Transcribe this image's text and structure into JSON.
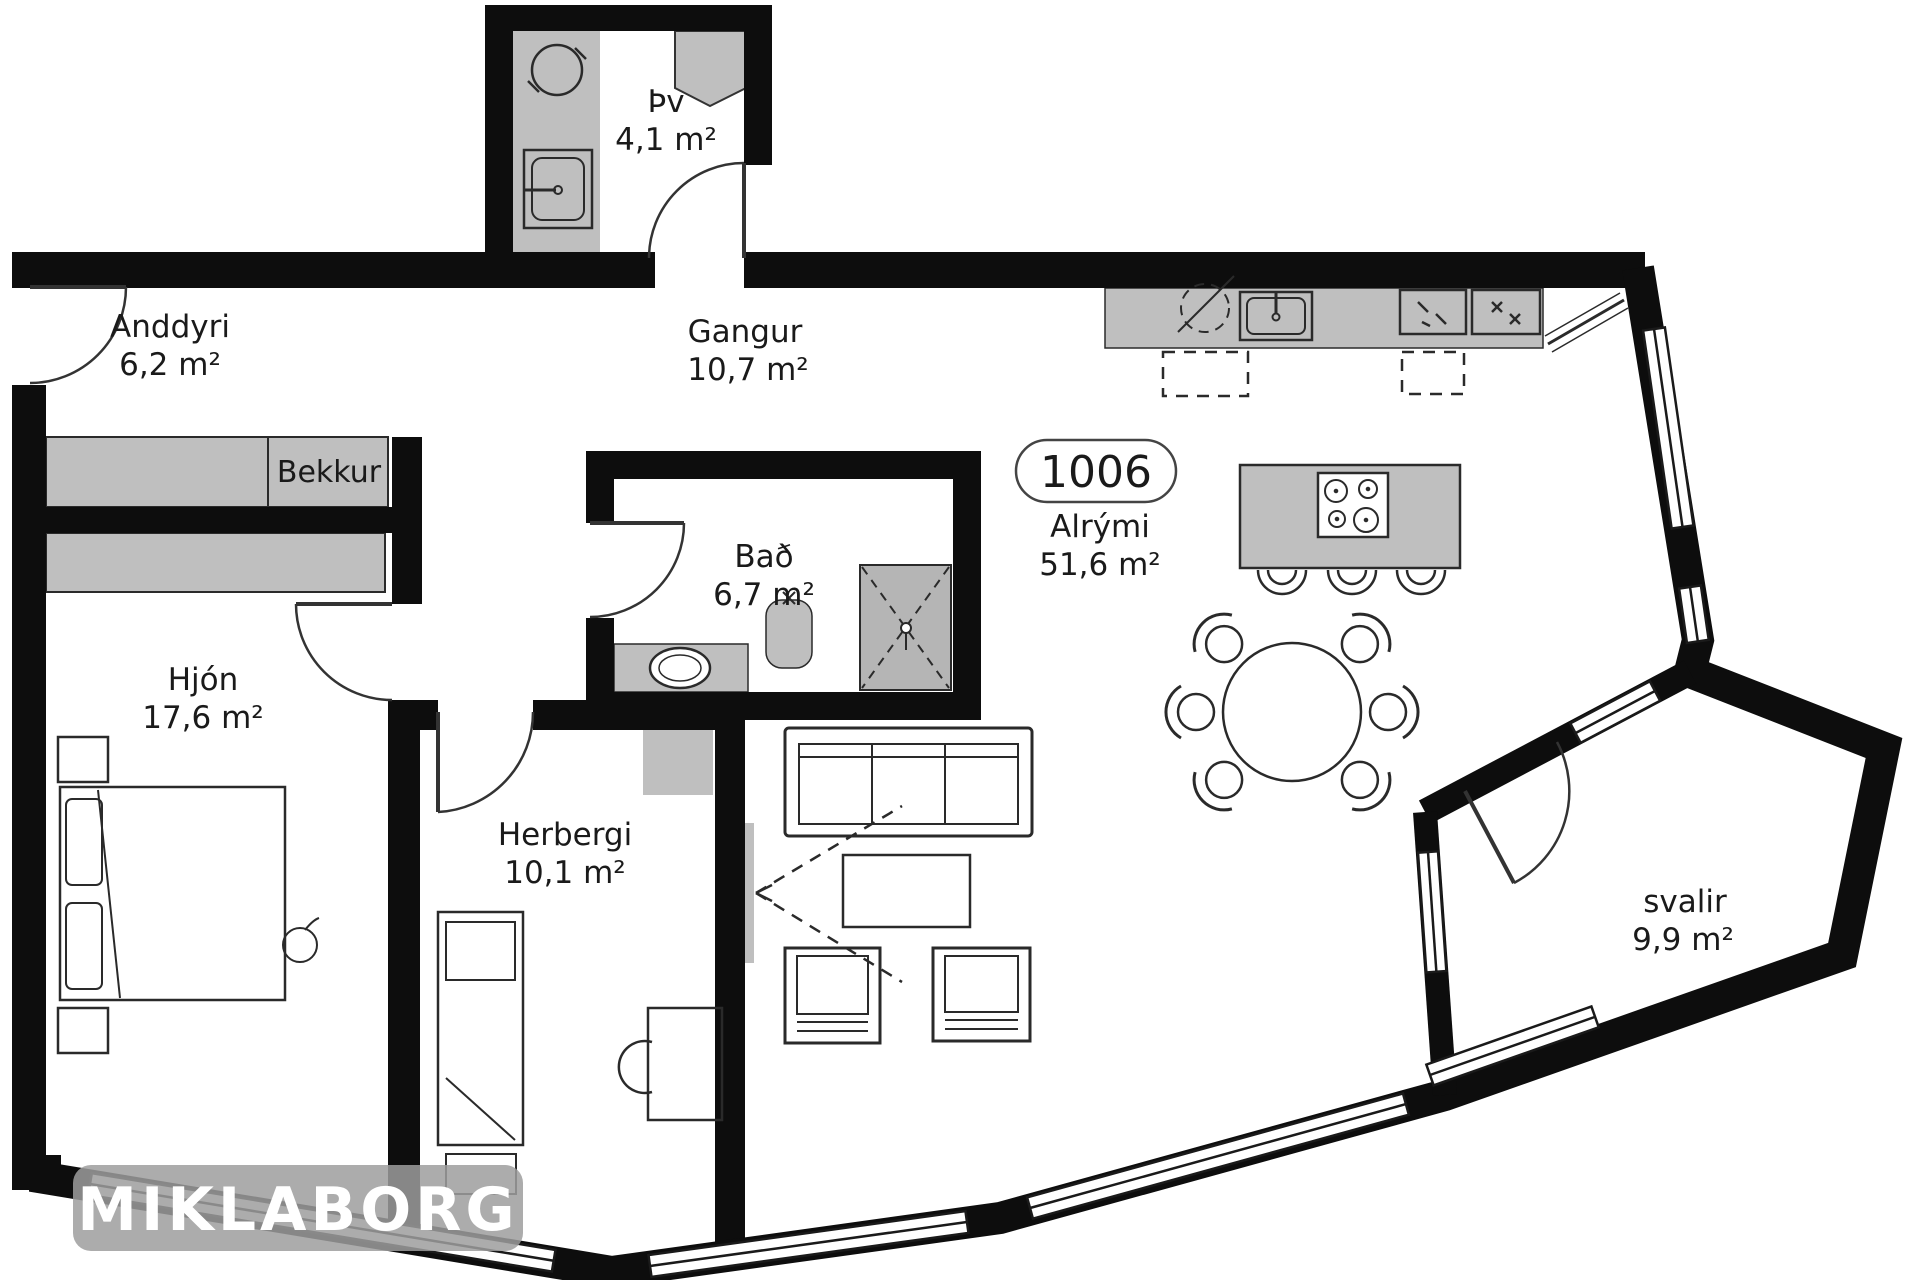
{
  "unit": {
    "number": "1006"
  },
  "rooms": {
    "anddyri": {
      "name": "Anddyri",
      "area": "6,2 m²"
    },
    "thvottahus": {
      "name": "Þv",
      "area": "4,1 m²"
    },
    "gangur": {
      "name": "Gangur",
      "area": "10,7 m²"
    },
    "bad": {
      "name": "Bað",
      "area": "6,7 m²"
    },
    "hjon": {
      "name": "Hjón",
      "area": "17,6 m²"
    },
    "herbergi": {
      "name": "Herbergi",
      "area": "10,1 m²"
    },
    "alrymi": {
      "name": "Alrými",
      "area": "51,6 m²"
    },
    "svalir": {
      "name": "svalir",
      "area": "9,9 m²"
    }
  },
  "labels": {
    "bench": "Bekkur"
  },
  "watermark": {
    "text": "MIKLABORG"
  },
  "icons": [
    "washing-machine-icon",
    "laundry-sink-icon",
    "water-heater-icon",
    "kitchen-sink-icon",
    "dishwasher-icon",
    "oven-icon",
    "fridge-icon",
    "cooktop-icon",
    "shower-icon",
    "toilet-icon",
    "vanity-sink-icon",
    "tv-icon",
    "door-swing-arc",
    "window-strip"
  ],
  "colors": {
    "wall": "#0d0d0d",
    "furniture": "#bfbfbf",
    "shower": "#b5b5b5",
    "watermark_bg": "#9e9e9e",
    "text": "#1a1a1a",
    "window_fill": "#ffffff"
  }
}
